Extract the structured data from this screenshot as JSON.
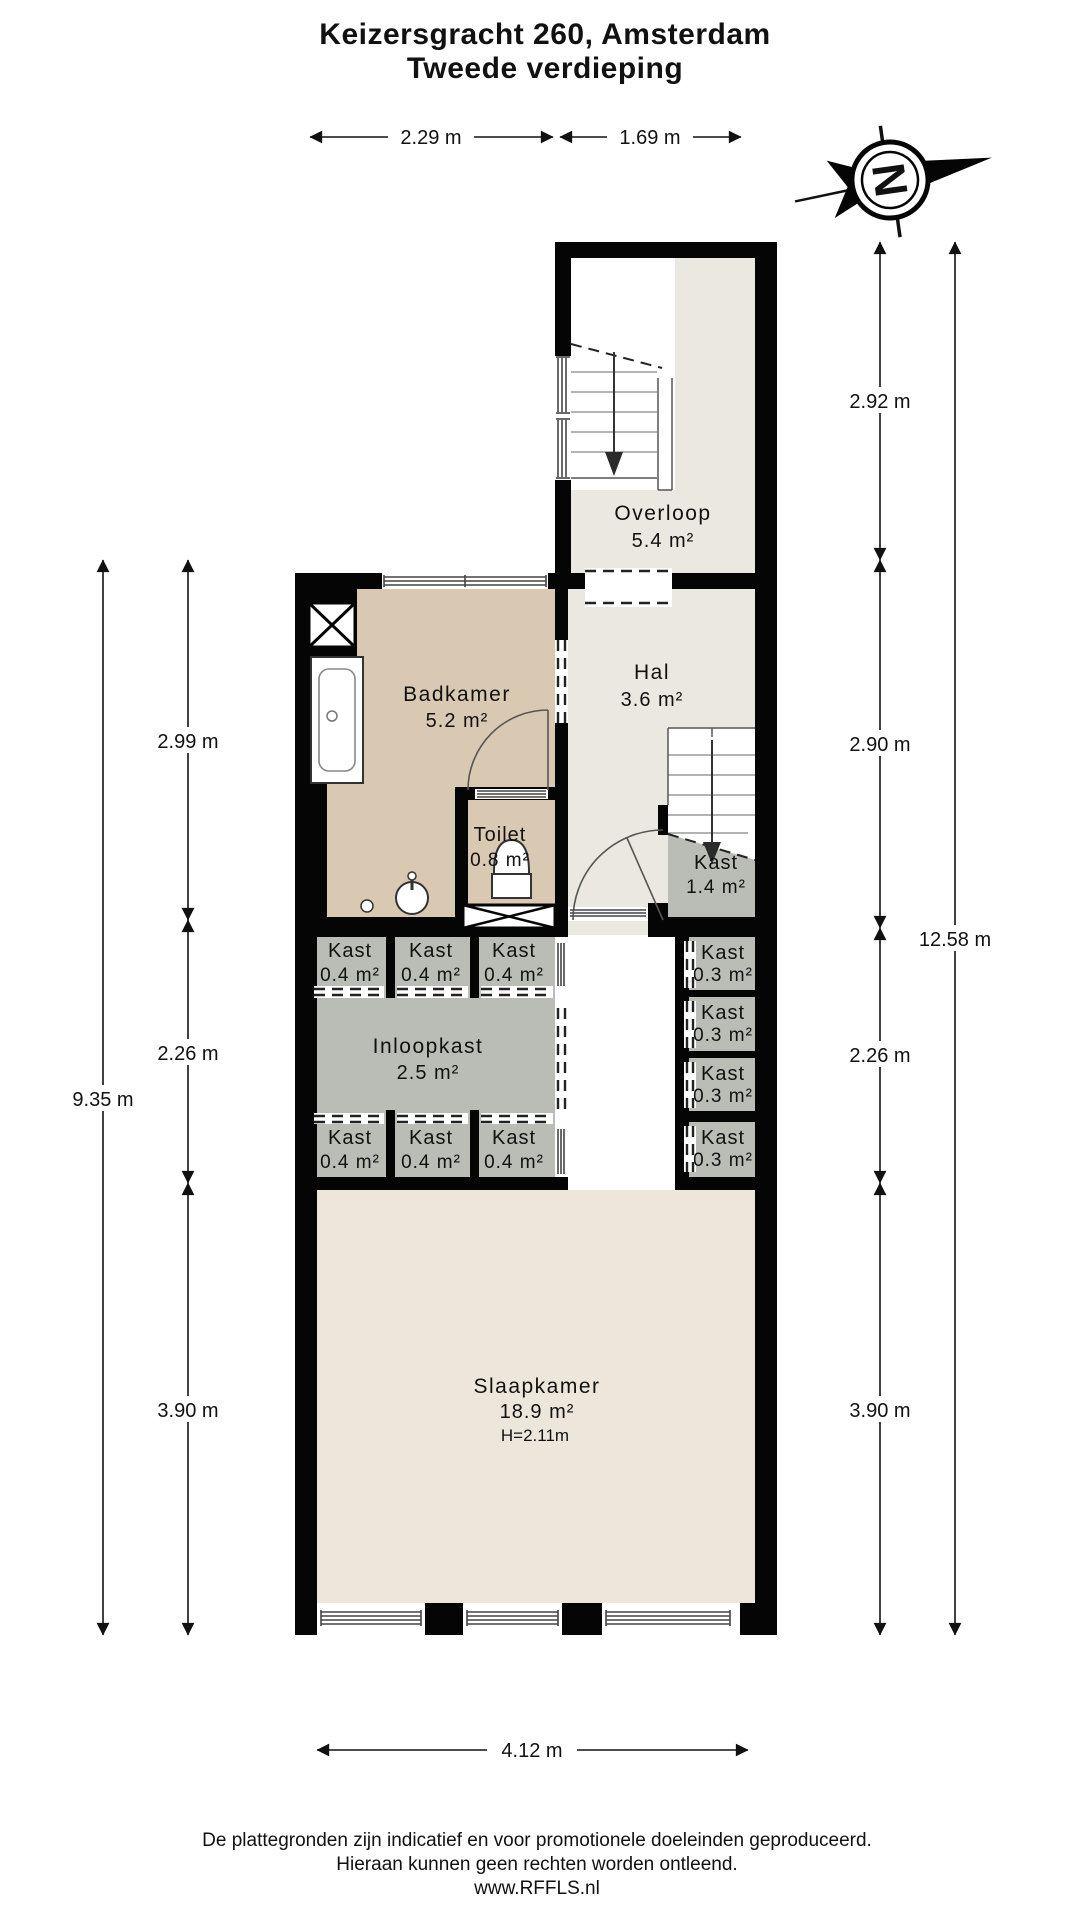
{
  "title": {
    "line1": "Keizersgracht 260, Amsterdam",
    "line2": "Tweede verdieping"
  },
  "compass": {
    "north_letter": "N"
  },
  "rooms": {
    "overloop": {
      "name": "Overloop",
      "area": "5.4 m²"
    },
    "hal": {
      "name": "Hal",
      "area": "3.6 m²"
    },
    "badkamer": {
      "name": "Badkamer",
      "area": "5.2 m²"
    },
    "toilet": {
      "name": "Toilet",
      "area": "0.8 m²"
    },
    "kast_onder_trap": {
      "name": "Kast",
      "area": "1.4 m²"
    },
    "inloopkast": {
      "name": "Inloopkast",
      "area": "2.5 m²"
    },
    "slaapkamer": {
      "name": "Slaapkamer",
      "area": "18.9 m²",
      "ceiling_height": "H=2.11m"
    },
    "kasten_links_boven": [
      {
        "name": "Kast",
        "area": "0.4 m²"
      },
      {
        "name": "Kast",
        "area": "0.4 m²"
      },
      {
        "name": "Kast",
        "area": "0.4 m²"
      }
    ],
    "kasten_links_onder": [
      {
        "name": "Kast",
        "area": "0.4 m²"
      },
      {
        "name": "Kast",
        "area": "0.4 m²"
      },
      {
        "name": "Kast",
        "area": "0.4 m²"
      }
    ],
    "kasten_rechts": [
      {
        "name": "Kast",
        "area": "0.3 m²"
      },
      {
        "name": "Kast",
        "area": "0.3 m²"
      },
      {
        "name": "Kast",
        "area": "0.3 m²"
      },
      {
        "name": "Kast",
        "area": "0.3 m²"
      }
    ]
  },
  "dimensions": {
    "top": [
      "2.29 m",
      "1.69 m"
    ],
    "left_outer": "9.35 m",
    "left_inner": [
      "2.99 m",
      "2.26 m",
      "3.90 m"
    ],
    "right_inner": [
      "2.92 m",
      "2.90 m",
      "2.26 m",
      "3.90 m"
    ],
    "right_outer": "12.58 m",
    "bottom": "4.12 m"
  },
  "footer": {
    "line1": "De plattegronden zijn indicatief en voor promotionele doeleinden geproduceerd.",
    "line2": "Hieraan kunnen geen rechten worden ontleend.",
    "line3": "www.RFFLS.nl"
  },
  "colors": {
    "wall": "#050505",
    "bathroom_floor": "#d9c8b2",
    "hall_floor": "#eae8e1",
    "bedroom_floor": "#ece7da",
    "closet_fill": "#b9bdb5"
  }
}
